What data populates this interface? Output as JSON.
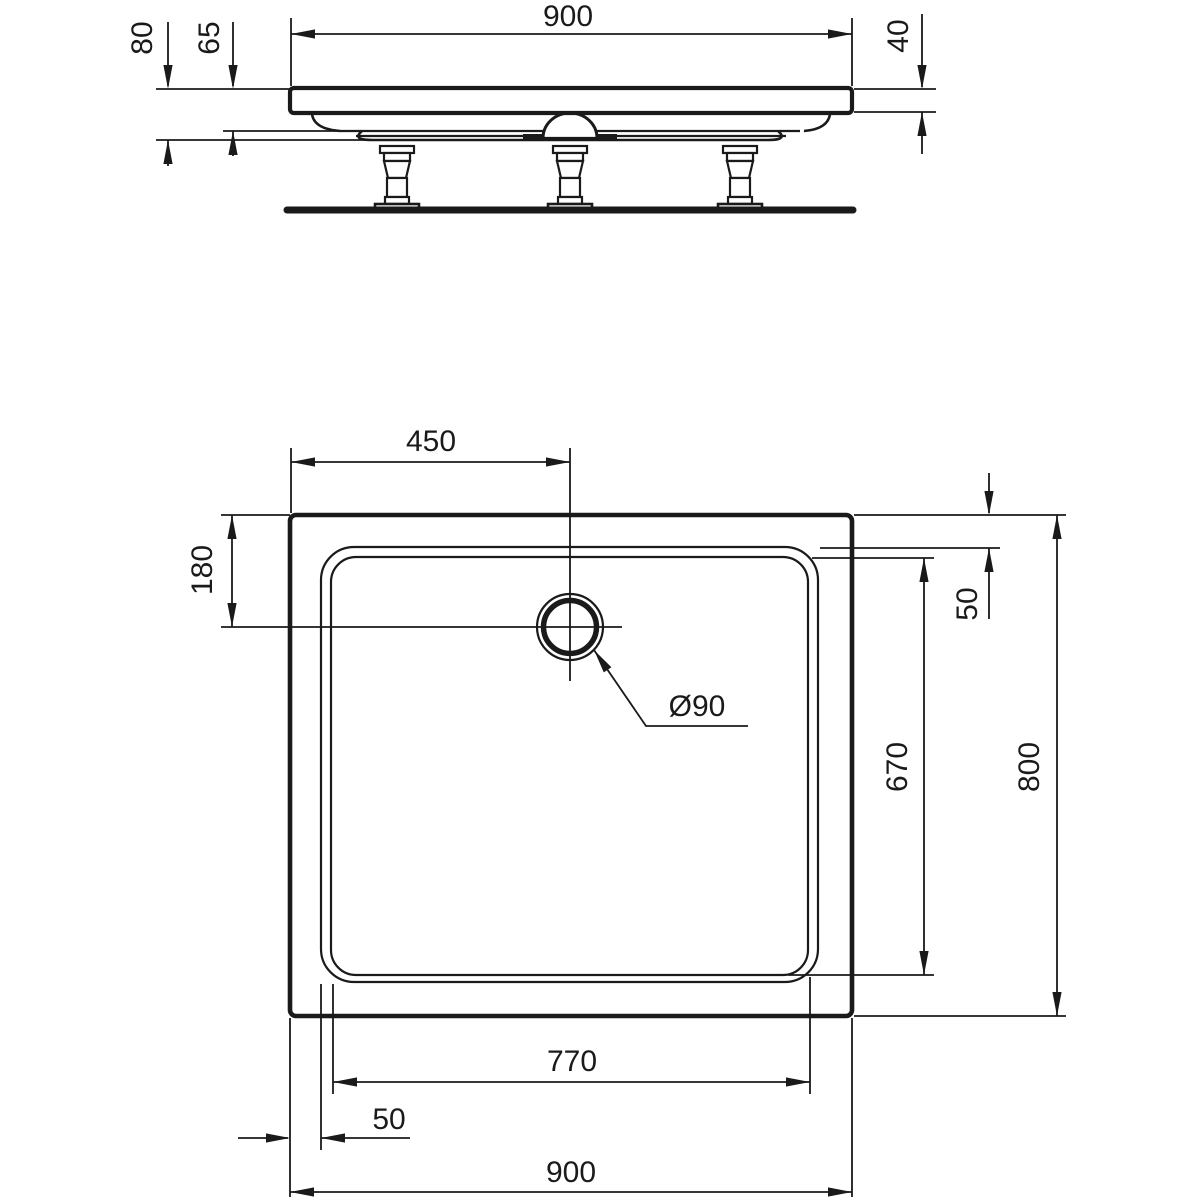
{
  "colors": {
    "line": "#1a1a1a",
    "background": "#ffffff"
  },
  "side_view": {
    "dims": {
      "overall_width": "900",
      "total_height": "80",
      "body_height": "65",
      "rim_thickness": "40"
    }
  },
  "plan_view": {
    "dims": {
      "drain_offset_x": "450",
      "drain_offset_y": "180",
      "rim_inset_top": "50",
      "basin_length": "670",
      "overall_depth": "800",
      "basin_width": "770",
      "rim_inset_left": "50",
      "overall_width": "900",
      "drain_diameter": "Ø90"
    }
  }
}
